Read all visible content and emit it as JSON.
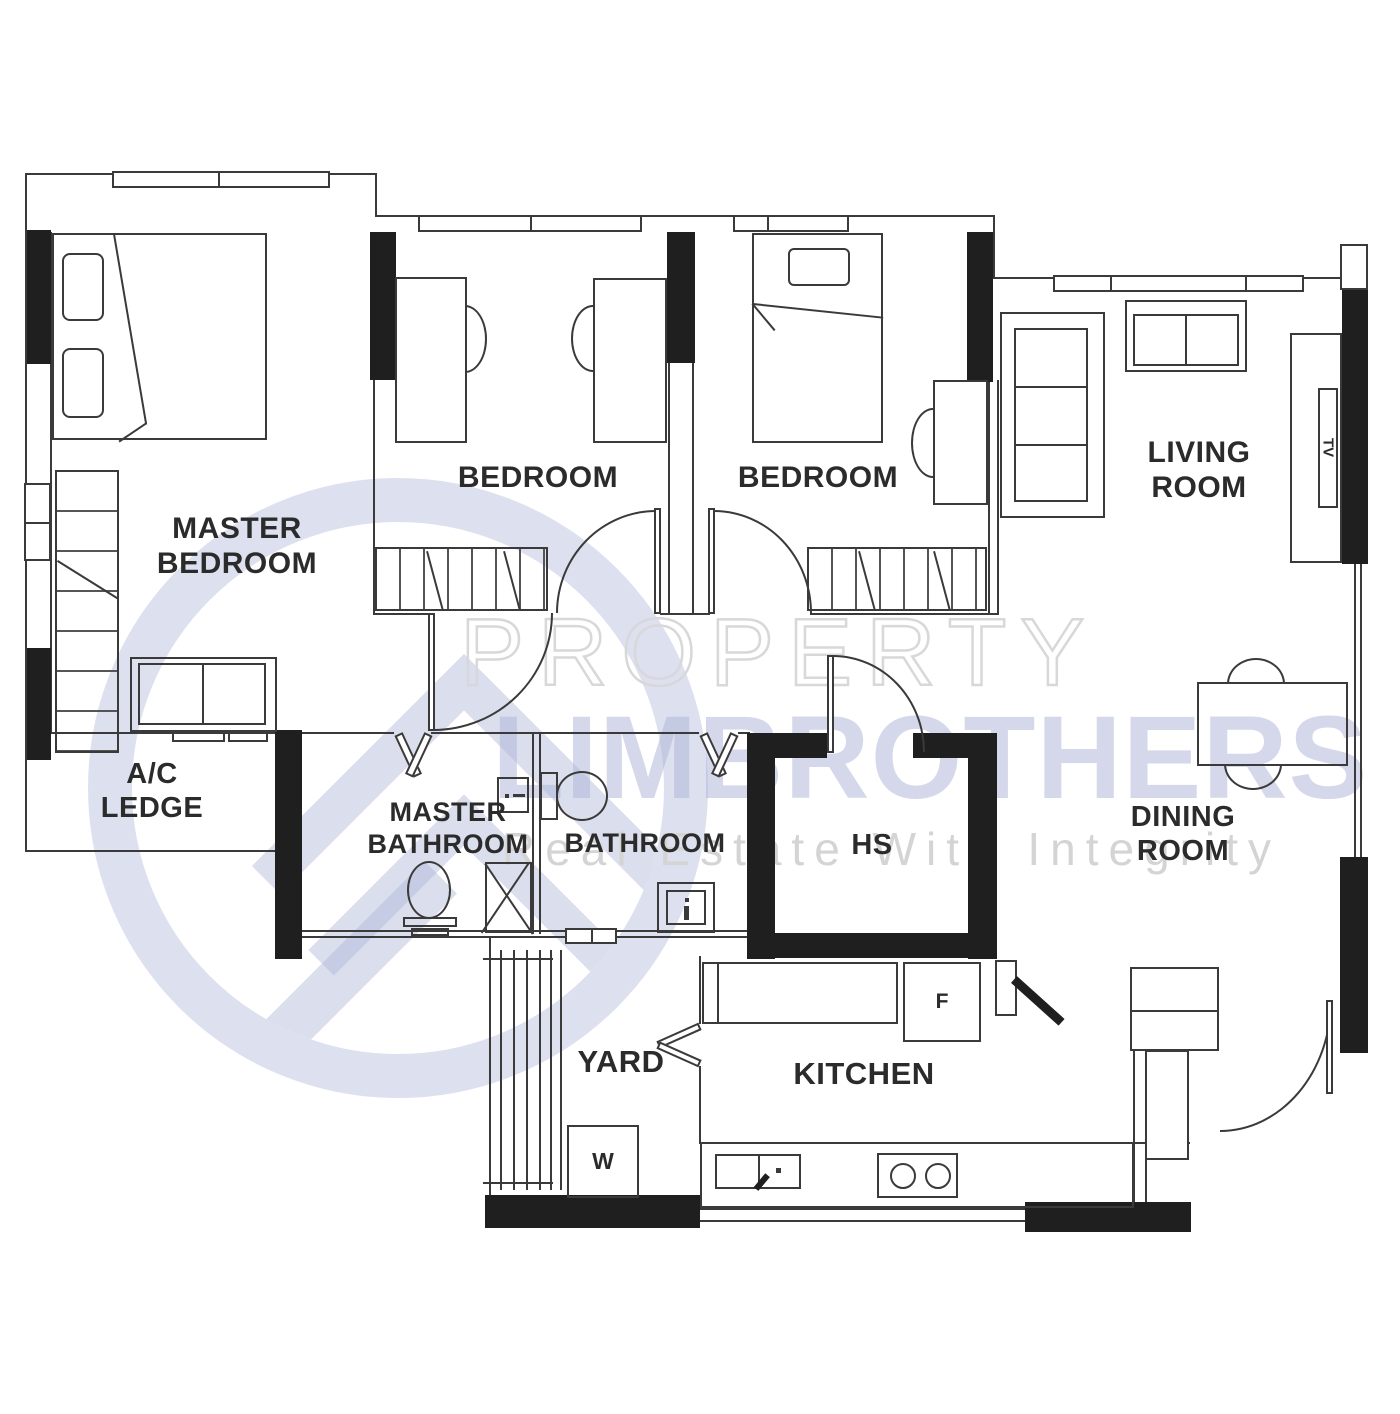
{
  "watermark": {
    "brand_top": "PROPERTY",
    "brand_bottom": "LIMBROTHERS",
    "tagline": "Real Estate With Integrity"
  },
  "labels": {
    "master_bedroom": "MASTER\nBEDROOM",
    "bedroom_1": "BEDROOM",
    "bedroom_2": "BEDROOM",
    "living_room": "LIVING\nROOM",
    "ac_ledge": "A/C\nLEDGE",
    "master_bathroom": "MASTER\nBATHROOM",
    "bathroom": "BATHROOM",
    "household_shelter": "HS",
    "dining_room": "DINING\nROOM",
    "yard": "YARD",
    "kitchen": "KITCHEN",
    "washer": "W",
    "fridge": "F",
    "tv": "TV"
  },
  "colors": {
    "background": "#ffffff",
    "wall_fill": "#1f1f1f",
    "line": "#3a3a3a",
    "label_text": "#2b2b2b",
    "watermark_blue": "#aeb6d8",
    "watermark_gray": "#d7d7d9"
  }
}
